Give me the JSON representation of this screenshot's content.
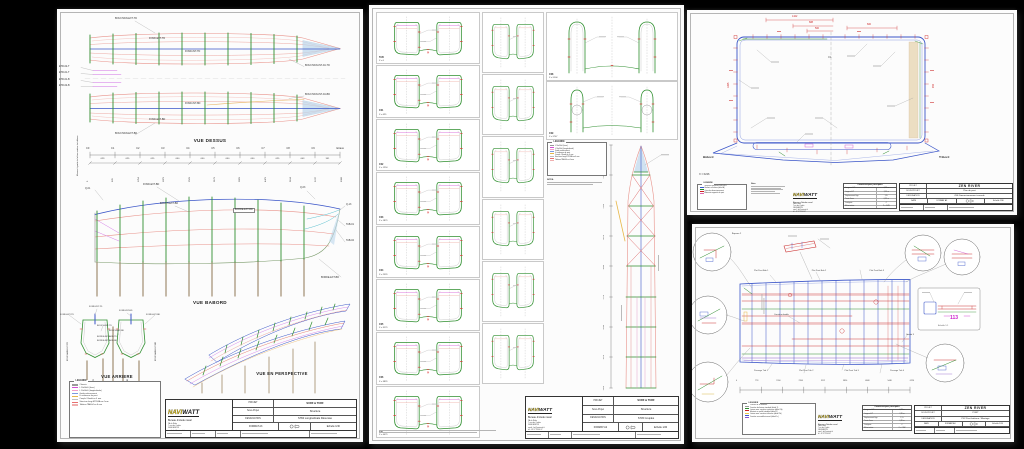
{
  "brand": {
    "navi": "NAVI",
    "watt": "WATT",
    "bureau": "Bureau d'étude naval",
    "addr": [
      "ZA du Rédo",
      "7 rue des Cadets",
      "56640 ARZON",
      "email : be@naviwatt.fr",
      "tél : 02 97 53 44 67"
    ]
  },
  "sheet1": {
    "titles": {
      "dessus": "VUE DESSUS",
      "babord": "VUE BABORD",
      "arriere": "VUE ARRIERE",
      "perspective": "VUE EN PERSPECTIVE"
    },
    "dessus": {
      "l1": "BOUCHAIN-EXT-TD",
      "l2": "FOND-EXT-TD",
      "l3": "FOND-INT-TD",
      "l4": "BOUCHAIN-INT-AV-TD",
      "l5": "BOUCHAIN-INT-AV-BD",
      "l6": "FOND-INT-BD",
      "l7": "FOND-EXT-BD",
      "l8": "BOUCHAIN-EXT-BD",
      "e1": "ETR-02-T",
      "e2": "ETR-01-T",
      "e3": "ETR-01-B",
      "e4": "ETR-02-B"
    },
    "babord": {
      "q1": "Q-01",
      "f1": "FOND-EXT-BD",
      "b1": "BOUCH-EXT-BD",
      "bo1": "BORDE-EXT-BD",
      "q3": "Q-03",
      "q13": "Q-13",
      "t1": "TAB-01",
      "t2": "TAB-02",
      "bo2": "BORDE-EXT-BD"
    },
    "arriere": {
      "a1": "FOND-INT-TD",
      "a2": "FOND-INT-BD",
      "a3": "FOND-EXT-TD",
      "a4": "FOND-EXT-BD",
      "a5": "BOUCH-INT-TD",
      "a6": "BOUCH-INT-BD",
      "a7": "BORDE-INT-ARR-TD",
      "a8": "BORDE-INT-ARR-BD",
      "a9": "BOUCHAIN-EXT-TD",
      "a10": "BORDE-INT-AV-TD",
      "a11": "BORDE-INT-AV-BD",
      "a12": "BOUCHAIN-EXT-BD"
    },
    "scale": {
      "note": "Mesure à partir de la face arrière du tableau",
      "stations": [
        "C0",
        "C1",
        "C2",
        "C3",
        "C4",
        "C5",
        "C6",
        "C7",
        "C8",
        "C9",
        "Etrave"
      ],
      "segments": [
        "629",
        "625",
        "625",
        "650",
        "650",
        "650",
        "650",
        "625",
        "643",
        "351"
      ],
      "cumul": [
        "0",
        "629",
        "1254",
        "1879",
        "2529",
        "3179",
        "3829",
        "4479",
        "5104",
        "5747",
        "6098"
      ]
    },
    "legend": {
      "title": "LEGENDE",
      "items": [
        {
          "c": "#9a9a9a",
          "t": "Chassis"
        },
        {
          "c": "#d550d5",
          "t": "L 50x50x5 (lisse)"
        },
        {
          "c": "#f0a0c8",
          "t": "L 50x50x5 (longitudinale)"
        },
        {
          "c": "#7a9ae0",
          "t": "Guide enfoncement"
        },
        {
          "c": "#e8b84a",
          "t": "U raidisseur de pont"
        },
        {
          "c": "#c0c0c0",
          "t": "Couple / Bordé en 4 mm"
        },
        {
          "c": "#e87070",
          "t": "Structure longi ETR-BA en 4 mm"
        },
        {
          "c": "#f0b0b0",
          "t": "Tableau TAB-04 en 6 mm"
        }
      ]
    },
    "tb": {
      "projet_l": "PROJET",
      "projet": "SURF & TURF",
      "sous_l": "Sous-Projet",
      "sous": "Structure",
      "des_l": "DESIGNATION",
      "des": "S784 Longitudinale Résumée",
      "format": "FORMAT A3",
      "echelle": "Echelle 1/30"
    }
  },
  "sheet2": {
    "left_panels": [
      {
        "n": "TAB",
        "x": "X = 0"
      },
      {
        "n": "C01",
        "x": "X = 629"
      },
      {
        "n": "C02",
        "x": "X = 1254"
      },
      {
        "n": "C03",
        "x": "X = 1879"
      },
      {
        "n": "C04",
        "x": "X = 2529"
      },
      {
        "n": "C05",
        "x": "X = 3179"
      },
      {
        "n": "C06",
        "x": "X = 3829"
      },
      {
        "n": "C07",
        "x": "X = 4479"
      }
    ],
    "mid_panels": [
      "",
      "",
      "",
      "",
      "",
      ""
    ],
    "r1": {
      "n": "C08",
      "x": "X = 5104"
    },
    "r2": {
      "n": "C09",
      "x": "X = 5747"
    },
    "ruler": [
      "6098",
      "5747",
      "5104",
      "4479",
      "3829",
      "3179",
      "2529",
      "1879",
      "1254"
    ],
    "nota": "NOTA :",
    "tb": {
      "projet_l": "PROJET",
      "projet": "SURF & TURF",
      "sous_l": "Sous-Projet",
      "sous": "Structure",
      "des_l": "DESIGNATION",
      "des": "S745 Couples",
      "format": "FORMAT A2",
      "echelle": "Echelle 1/20"
    }
  },
  "sheet3": {
    "dims": {
      "d1": "1422",
      "d2": "688",
      "d3": "500",
      "d4": "600",
      "d5": "1265",
      "d6": "940"
    },
    "cl": "CL",
    "babord": "Bâbord",
    "tribord": "Tribord",
    "xref": "X = 6226",
    "legend": {
      "title": "LEGENDE",
      "items": [
        {
          "c": "#3a5bd0",
          "t": "Structure aluminium 5083 H111"
        },
        {
          "c": "#2a8a2a",
          "t": "Renforts et hiloires (détail A)"
        },
        {
          "c": "#cc2222",
          "t": "Cotes de dimensionnement"
        },
        {
          "c": "#dd66aa",
          "t": "Éléments rapportés du pont"
        }
      ]
    },
    "nota": "Nota",
    "caract": {
      "title": "Caractéristiques principales",
      "rows": [
        [
          "Longueur H.T",
          "6,23 m"
        ],
        [
          "Largeur H.T",
          "2,55 m"
        ],
        [
          "Déplacement lège",
          "1,9 t"
        ],
        [
          "Tirant d'eau",
          "0,35 m"
        ],
        [
          "Catégorie",
          "C"
        ],
        [
          "Motorisation",
          "2 × 4 kW"
        ]
      ]
    },
    "tb": {
      "projet_l": "PROJET",
      "projet": "ZEN RIVER",
      "sous_l": "SOUS-PROJET",
      "sous": "Plan de pont",
      "des_l": "DESIGNATION",
      "des": "Z06 Dimensionnement console",
      "date_l": "DATE",
      "format": "FORMAT A3",
      "echelle": "Echelle 1/30"
    }
  },
  "sheet4": {
    "top_labels": [
      "Plat Pont Bab 1",
      "Plat Pont Bab 2",
      "Plat Pont Bab 3"
    ],
    "bottom_labels": [
      "Passage Trib 1",
      "Plat Pont Trib 2",
      "Plat Pont Trib 3",
      "Passage Trib 4"
    ],
    "corniere": "Cornière double",
    "goulot": "Goulot 3",
    "equerre": "Équerre 2",
    "detail": {
      "dim": "113",
      "echelle": "Echelle 1:1"
    },
    "scale_values": [
      "0",
      "778",
      "1556",
      "2334",
      "3112",
      "3890",
      "4668",
      "5446",
      "6226"
    ],
    "legend": {
      "title": "LEGENDE",
      "items": [
        {
          "c": "#9a9a9a",
          "t": "Chassis de la structure"
        },
        {
          "c": "#2a8a2a",
          "t": "Cornière de liaison standard (détail 1)"
        },
        {
          "c": "#cc2222",
          "t": "Liaison avec cornière supérieure (détail 1b)"
        },
        {
          "c": "#e8c84a",
          "t": "Montant en profilé standard (détail 2)"
        },
        {
          "c": "#3a5bd0",
          "t": "Liaison avec cornière inférieure (détail 2b)"
        },
        {
          "c": "#8855cc",
          "t": "Cornière ou modèle inversé (détail 1c)"
        }
      ]
    },
    "tb": {
      "projet_l": "PROJET",
      "projet": "ZEN RIVER",
      "sous_l": "SOUS-PROJET",
      "sous": "PONT",
      "des_l": "DESIGNATION",
      "des": "P02 Pont Intérieur / Montage",
      "date_l": "DATE",
      "format": "FORMAT A3",
      "echelle": "Echelle 1/24"
    }
  }
}
